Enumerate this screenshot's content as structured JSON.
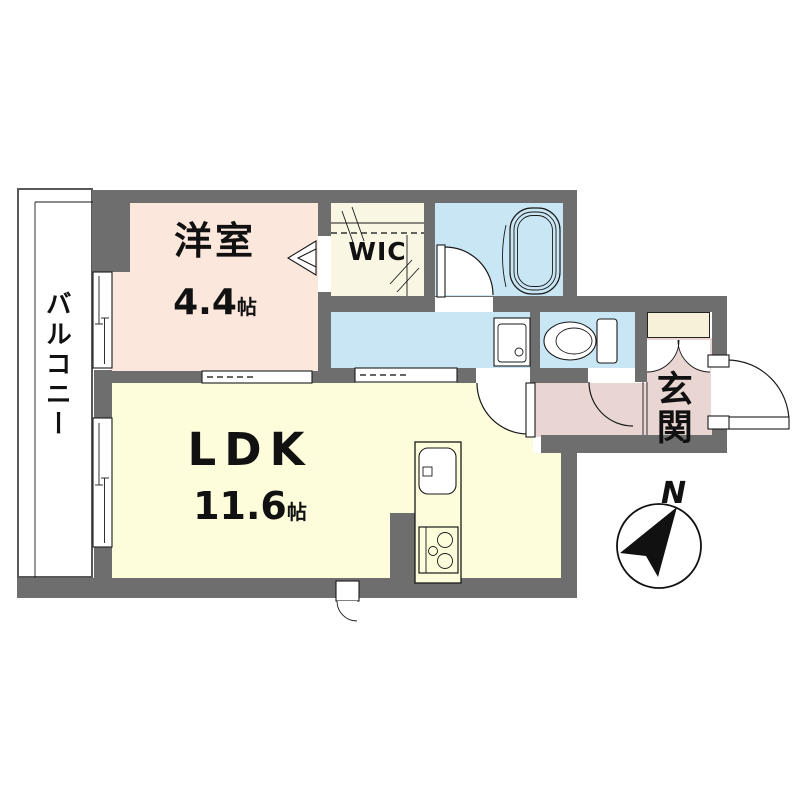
{
  "plan": {
    "balcony": {
      "label": "バルコニー"
    },
    "bedroom": {
      "label": "洋室",
      "size": "4.4",
      "unit": "帖"
    },
    "wic": {
      "label": "WIC"
    },
    "ldk": {
      "label": "LDK",
      "size": "11.6",
      "unit": "帖"
    },
    "entrance": {
      "label": "玄関"
    },
    "compass": {
      "north": "N"
    }
  },
  "colors": {
    "wall": "#6e6e6e",
    "bedroom": "#fbe7dc",
    "ldk": "#fdfcdb",
    "water": "#c9e6f4",
    "hall": "#e9d6d2",
    "wic": "#faf6e4",
    "cabinet": "#f6f1d8",
    "outline": "#1a1a1a"
  }
}
